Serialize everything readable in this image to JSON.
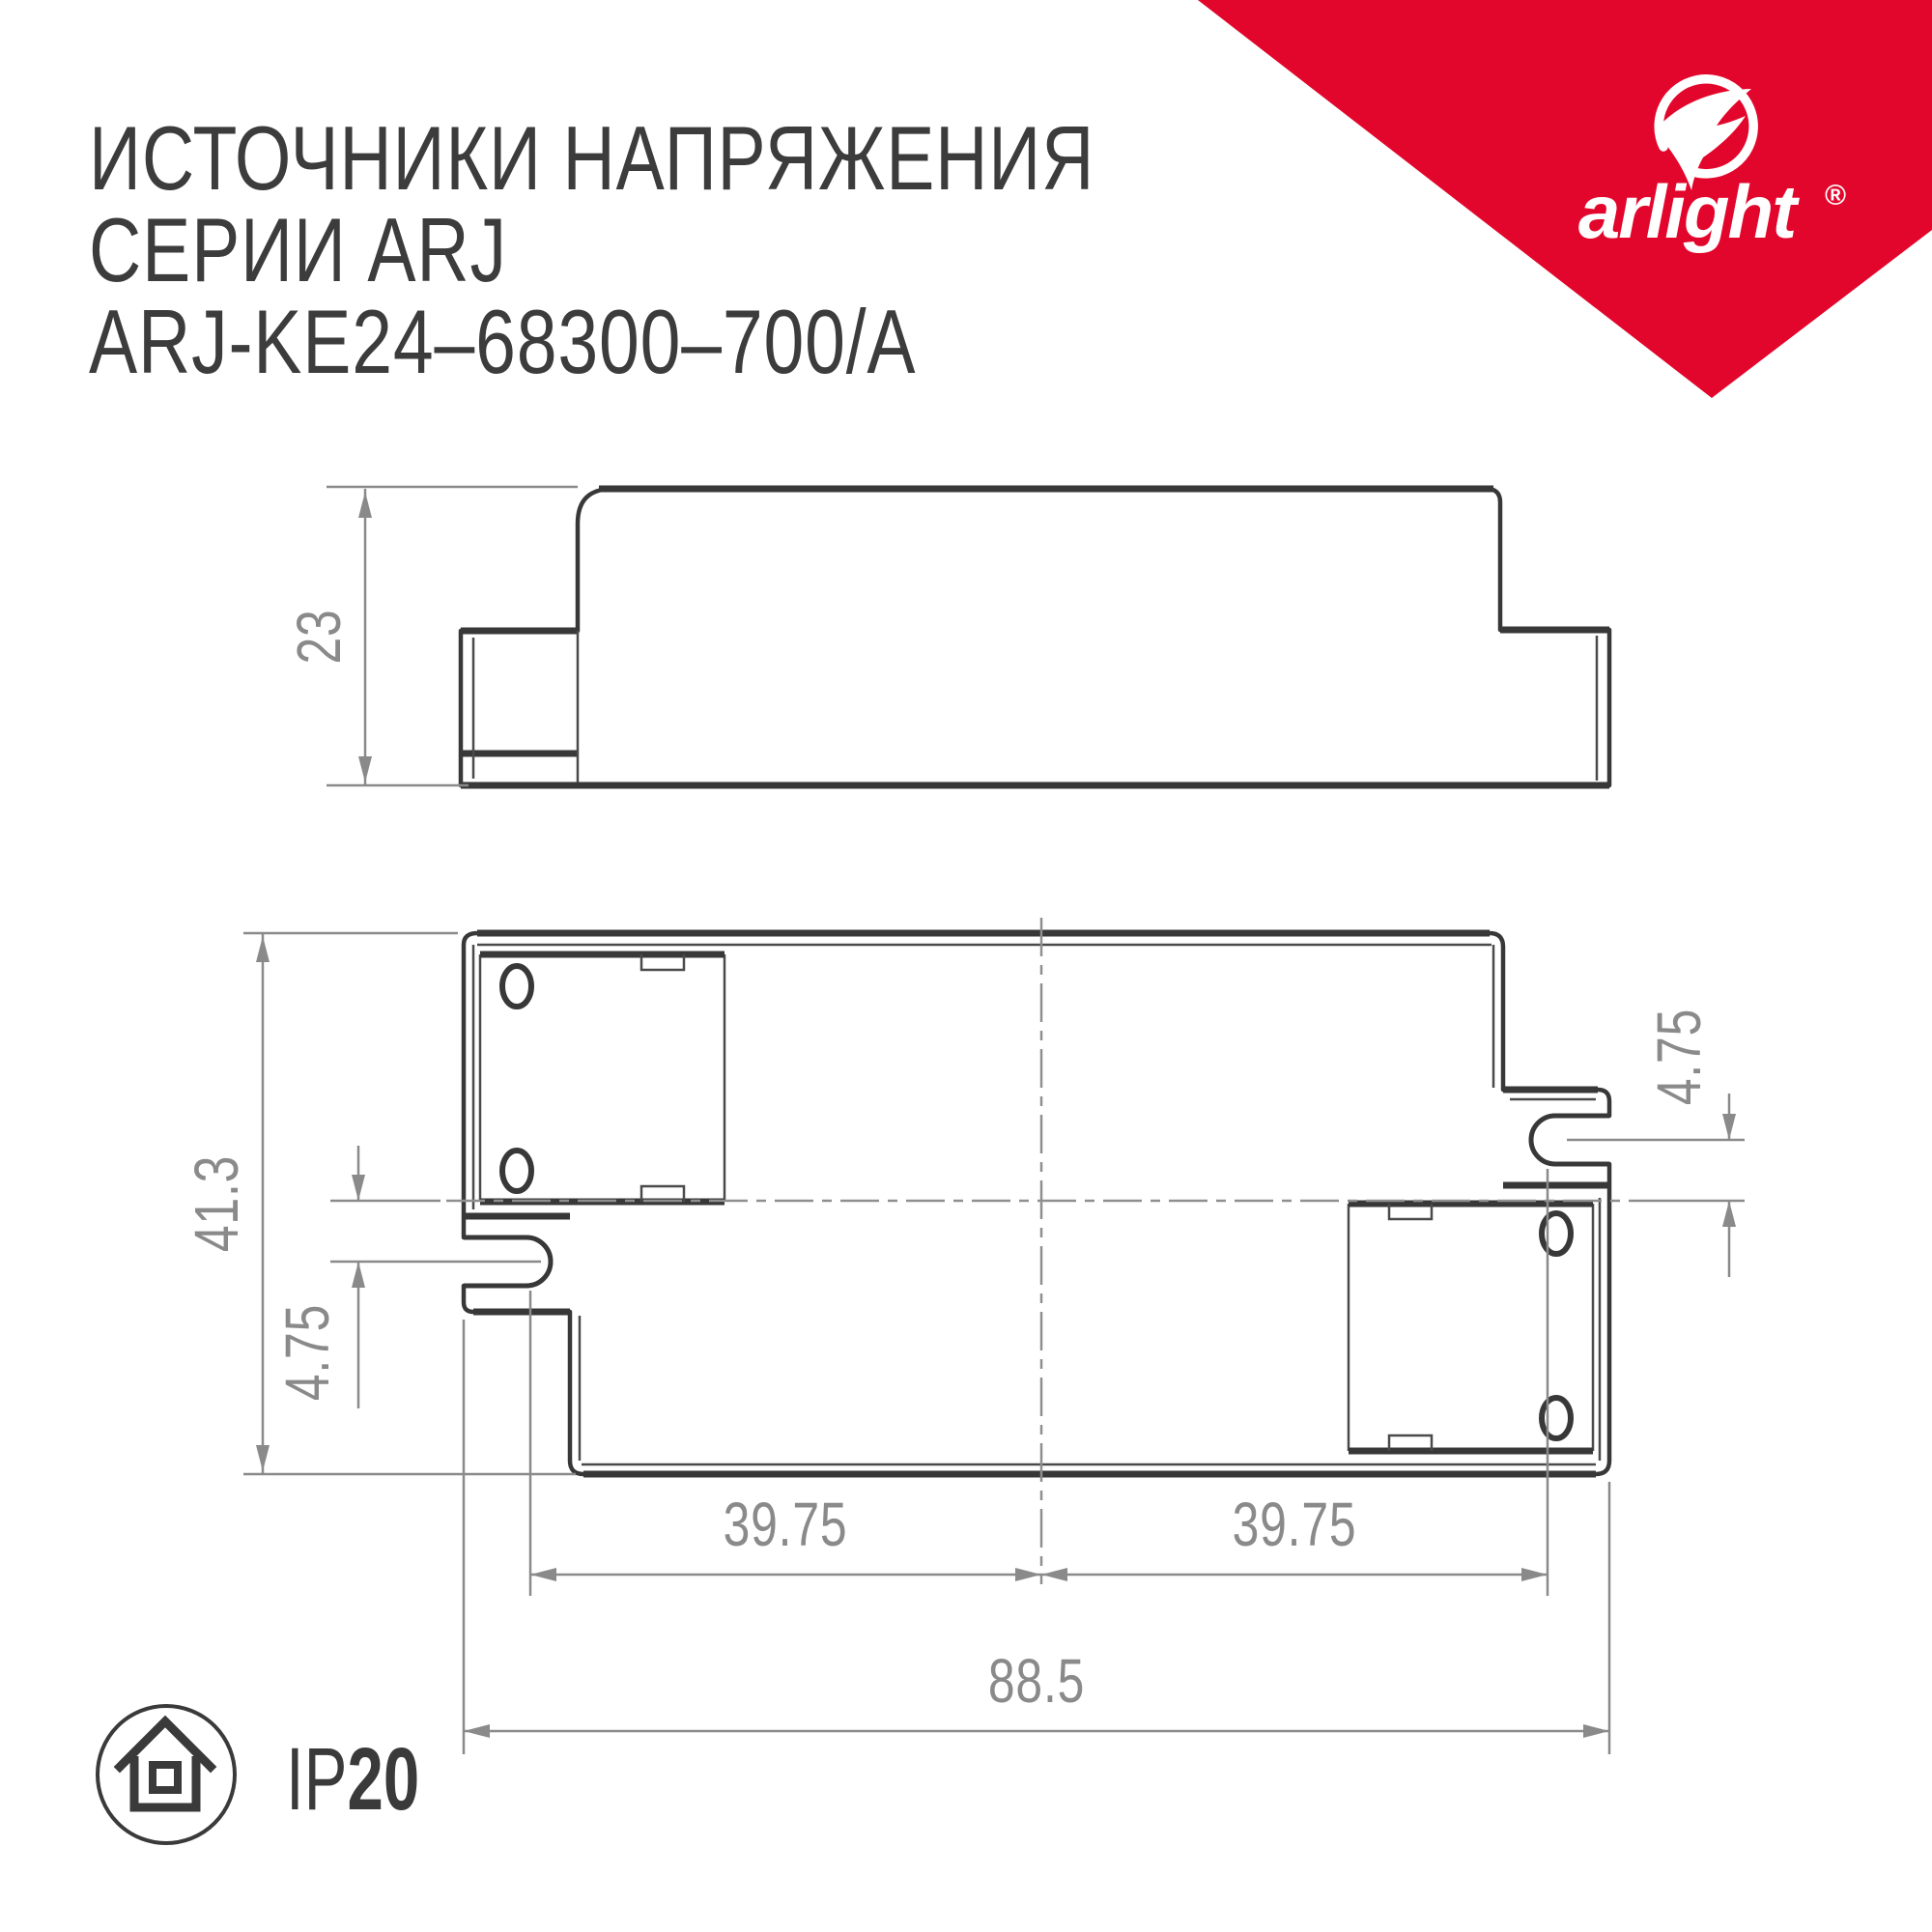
{
  "title": {
    "line1": "ИСТОЧНИКИ НАПРЯЖЕНИЯ",
    "line2": "СЕРИИ ARJ",
    "line3": "ARJ-KE24–68300–700/A"
  },
  "brand": {
    "name": "arlight",
    "registered": "®",
    "ribbon_color": "#E3062C",
    "icon": "arlight-swoosh-icon"
  },
  "drawing": {
    "line_color": "#383838",
    "dimension_color": "#8a8a8a",
    "side_view": {
      "height_label": "23"
    },
    "top_view": {
      "width_label": "41.3",
      "slot_offset_left_label": "4.75",
      "slot_offset_right_label": "4.75",
      "hole_pitch_left_label": "39.75",
      "hole_pitch_right_label": "39.75",
      "overall_length_label": "88.5"
    }
  },
  "footer": {
    "ip_prefix": "IP",
    "ip_value": "20",
    "icon": "house-icon"
  }
}
